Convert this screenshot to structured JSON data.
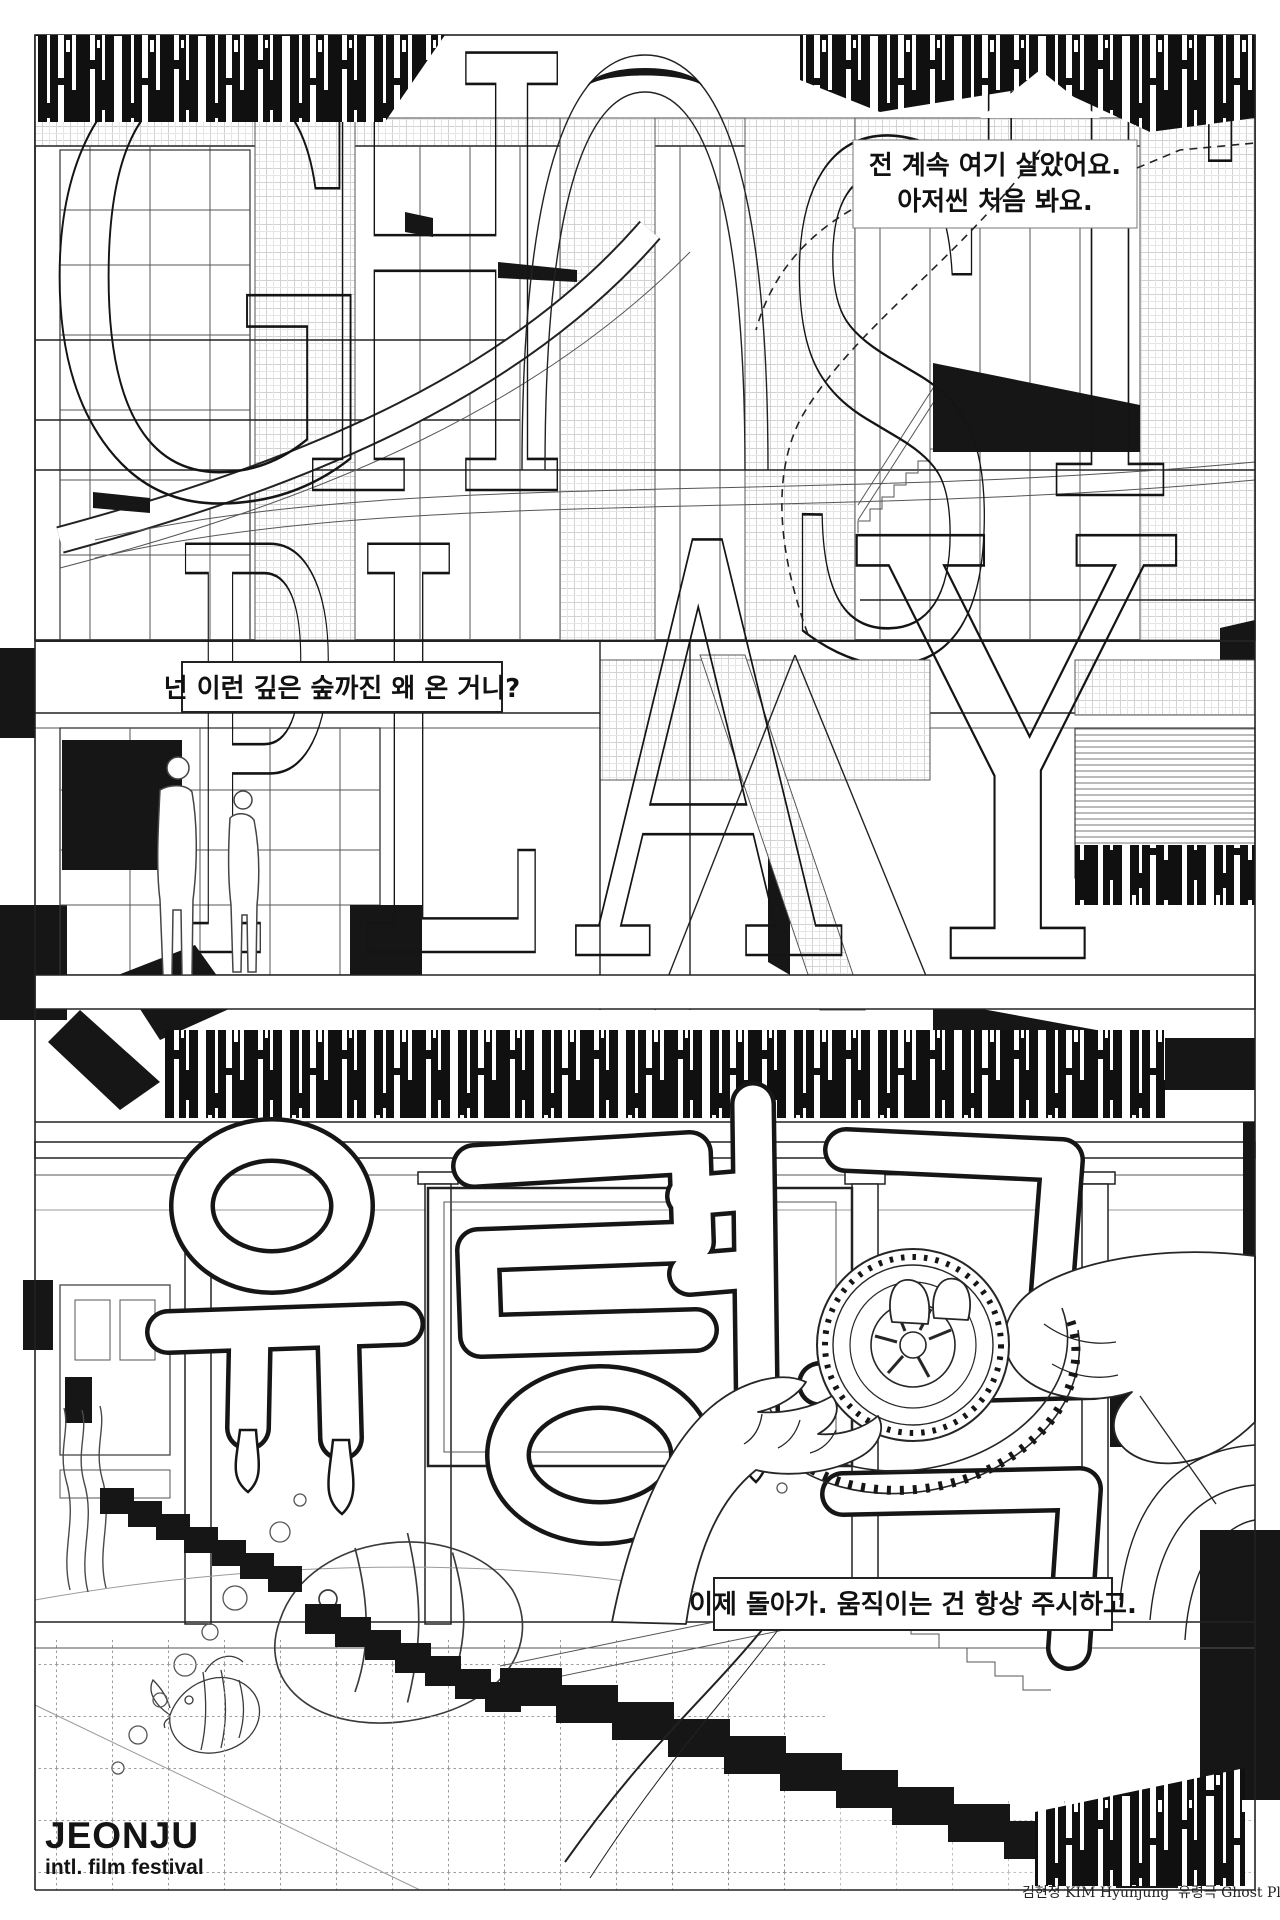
{
  "poster": {
    "festival": {
      "name": "JEONJU",
      "subtitle": "intl. film festival"
    },
    "title": {
      "english_word_top": "GHOST",
      "english_word_bottom": "PLAY",
      "ghost_letters": [
        "G",
        "H",
        "O",
        "S",
        "T"
      ],
      "play_letters": [
        "P",
        "L",
        "A",
        "Y"
      ],
      "korean": "유령극",
      "english": "Ghost Play"
    },
    "dialogue": {
      "bubble_top_right": {
        "line1": "전 계속 여기 살았어요.",
        "line2": "아저씬 처음 봐요."
      },
      "bubble_middle_left": {
        "line1": "넌 이런 깊은 숲까진 왜 온 거니?"
      },
      "bubble_bottom_right": {
        "line1": "이제 돌아가. 움직이는 건 항상 주시하고."
      }
    },
    "credits": {
      "artist": "김현정 KIM Hyunjung",
      "work": "유령극 Ghost Play"
    },
    "colors": {
      "ink": "#161616",
      "paper": "#ffffff"
    }
  }
}
